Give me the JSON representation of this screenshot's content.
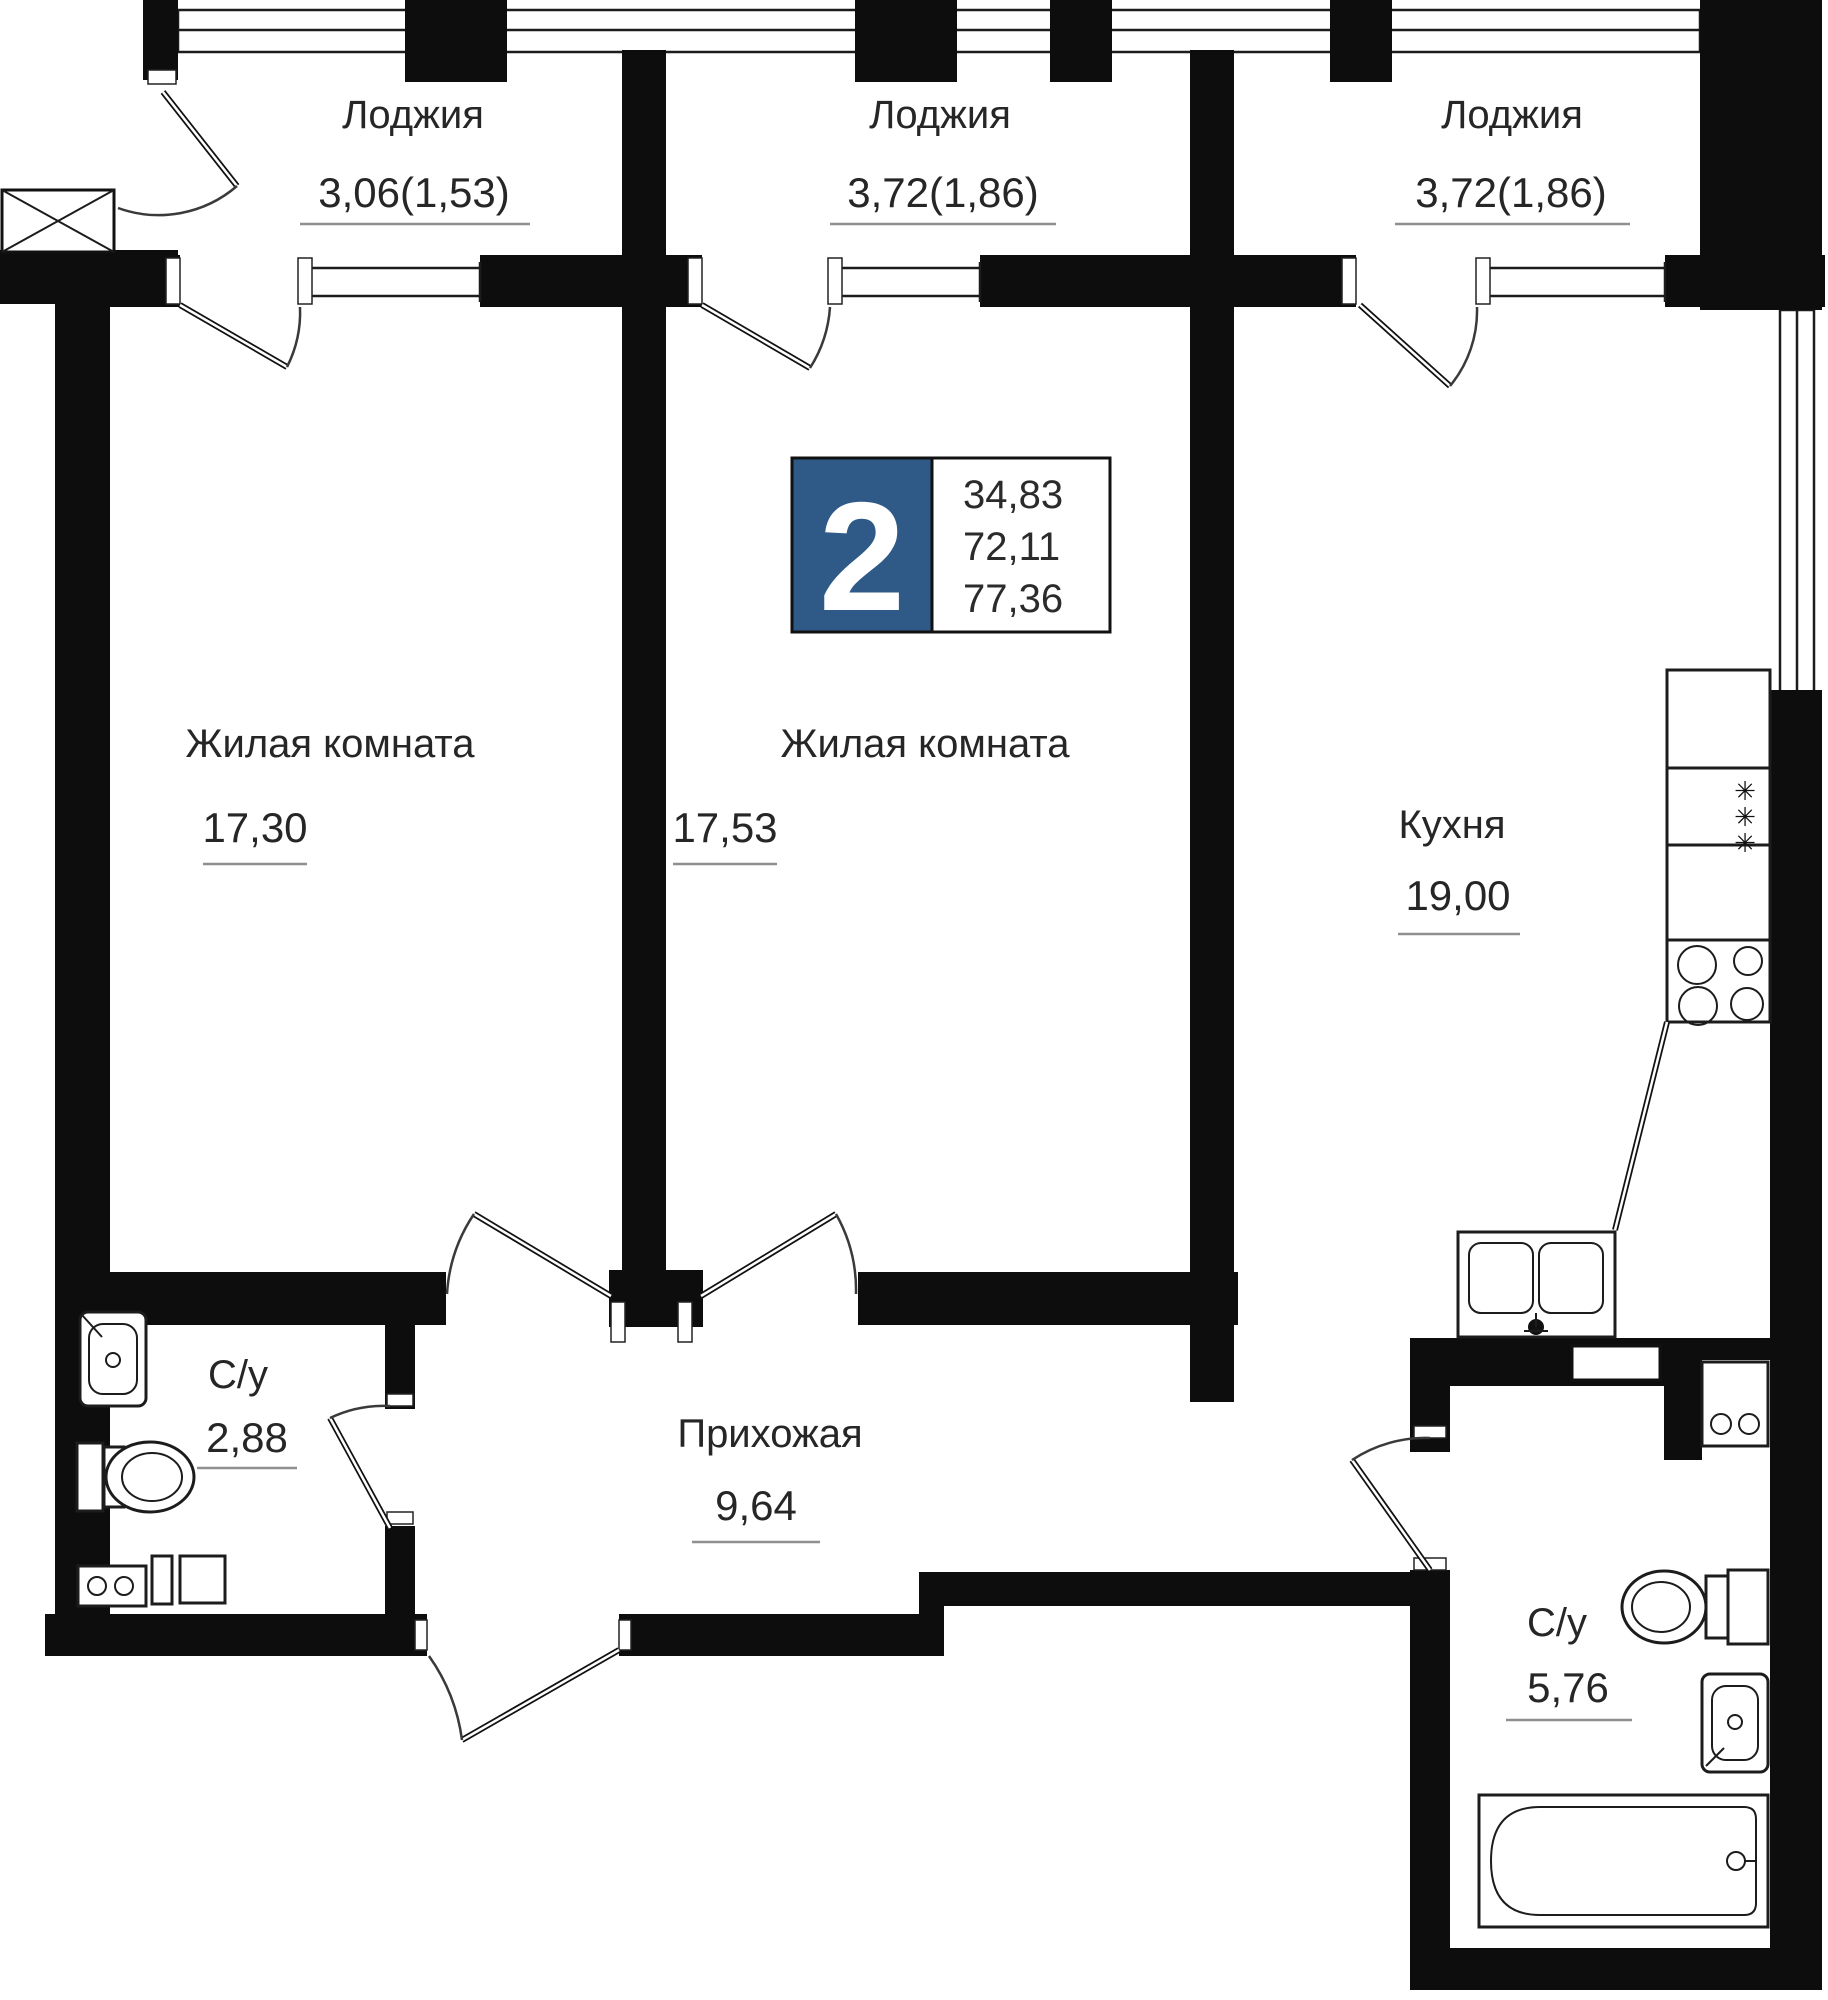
{
  "plan": {
    "title": "2-room apartment floor plan",
    "type_badge": {
      "rooms_count": "2",
      "area_living": "34,83",
      "area_without_loggia": "72,11",
      "area_total": "77,36"
    },
    "rooms": {
      "loggia_1": {
        "name": "Лоджия",
        "area": "3,06(1,53)"
      },
      "loggia_2": {
        "name": "Лоджия",
        "area": "3,72(1,86)"
      },
      "loggia_3": {
        "name": "Лоджия",
        "area": "3,72(1,86)"
      },
      "living_1": {
        "name": "Жилая комната",
        "area": "17,30"
      },
      "living_2": {
        "name": "Жилая комната",
        "area": "17,53"
      },
      "kitchen": {
        "name": "Кухня",
        "area": "19,00"
      },
      "bathroom_1": {
        "name": "С/у",
        "area": "2,88"
      },
      "hallway": {
        "name": "Прихожая",
        "area": "9,64"
      },
      "bathroom_2": {
        "name": "С/у",
        "area": "5,76"
      }
    },
    "icons": {
      "fridge": "snowflake-icon",
      "stove": "burner-icon"
    },
    "colors": {
      "badge_blue": "#2f5a87",
      "wall": "#0d0d0d",
      "underline": "#8f8f8f",
      "text": "#262626"
    }
  }
}
